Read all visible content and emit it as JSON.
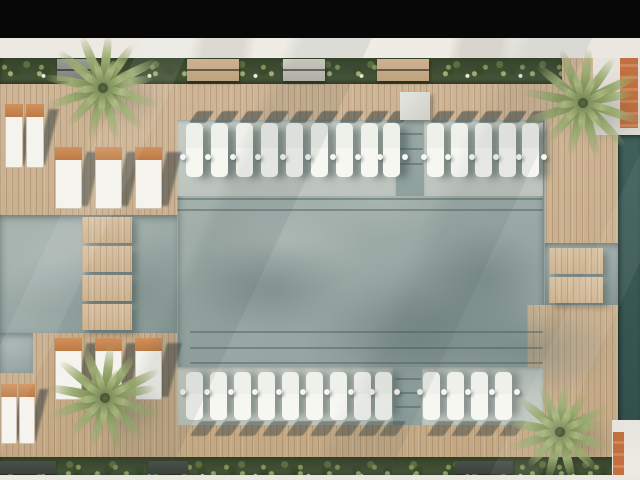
{
  "scene": {
    "type": "architectural-render-top-view",
    "subject": "Resort swimming pool seen from directly above: timber deck frame, two rows of white in-pool sun loungers with round side tables, timber stepping walkways crossing the water, cushioned lounge chairs on the deck, four palm trees, planting strips along the top and bottom edges, and a dark reflecting channel on the right.",
    "colors": {
      "letterbox": "#070707",
      "marble_walkway": "#ebe8e2",
      "wood_light": "#d8c2a4",
      "wood_mid": "#c7ad8c",
      "water_light": "#bcc4be",
      "water_mid": "#9fafab",
      "water_deep": "#839794",
      "channel_teal": "#3c5a56",
      "shelf_gray": "#c5cbc4",
      "lounger_white": "#f3f3ee",
      "chair_wood": "#c98a54",
      "shadow_tone": "#31424a",
      "green_dark": "#34422a",
      "palm_olive": "#8ba06b"
    },
    "lounger_rows": [
      {
        "id": "top",
        "y": 123,
        "w": 17,
        "h": 54,
        "table_y": 154,
        "shadow": "deck-above",
        "groups": [
          [
            186,
            211,
            236,
            261,
            286,
            311,
            336,
            361,
            383
          ],
          [
            427,
            451,
            475,
            499,
            522
          ]
        ]
      },
      {
        "id": "bottom",
        "y": 372,
        "w": 17,
        "h": 48,
        "table_y": 389,
        "shadow": "deck-below",
        "groups": [
          [
            186,
            210,
            234,
            258,
            282,
            306,
            330,
            354,
            375
          ],
          [
            423,
            447,
            471,
            495
          ]
        ]
      }
    ],
    "walkways": [
      {
        "id": "left",
        "x": 82,
        "w": 50,
        "seg_h": 26,
        "ys": [
          217,
          246,
          275,
          304
        ]
      },
      {
        "id": "right",
        "x": 549,
        "w": 54,
        "seg_h": 26,
        "ys": [
          248,
          277
        ]
      }
    ],
    "chair_groups": [
      {
        "id": "top-left-pair",
        "y": 104,
        "w": 18,
        "h": 64,
        "xs": [
          5,
          26
        ]
      },
      {
        "id": "top-row",
        "y": 147,
        "w": 27,
        "h": 62,
        "xs": [
          55,
          95,
          135
        ]
      },
      {
        "id": "bottom-row",
        "y": 338,
        "w": 27,
        "h": 62,
        "xs": [
          55,
          95,
          135
        ]
      },
      {
        "id": "bottom-left-pair",
        "y": 384,
        "w": 16,
        "h": 60,
        "xs": [
          1,
          19
        ]
      }
    ],
    "palms": [
      {
        "cx": 103,
        "cy": 88,
        "r": 62
      },
      {
        "cx": 583,
        "cy": 103,
        "r": 64
      },
      {
        "cx": 105,
        "cy": 398,
        "r": 62
      },
      {
        "cx": 560,
        "cy": 432,
        "r": 56
      }
    ],
    "planter_benches": [
      {
        "x": 57,
        "w": 34,
        "tone": "gray"
      },
      {
        "x": 187,
        "w": 52,
        "tone": "wood"
      },
      {
        "x": 283,
        "w": 42,
        "tone": "light"
      },
      {
        "x": 377,
        "w": 52,
        "tone": "wood"
      }
    ],
    "planter_boxes_bottom": [
      {
        "x": 0,
        "w": 56
      },
      {
        "x": 148,
        "w": 40
      },
      {
        "x": 455,
        "w": 58
      }
    ],
    "steps": [
      {
        "x": 177,
        "w": 366,
        "ys": [
          198,
          209
        ]
      },
      {
        "x": 190,
        "w": 353,
        "ys": [
          331,
          347,
          362
        ]
      },
      {
        "x": 397,
        "w": 26,
        "ys": [
          133,
          148,
          163
        ]
      },
      {
        "x": 395,
        "w": 26,
        "ys": [
          378,
          392,
          406
        ]
      }
    ],
    "shadow_blobs": [
      {
        "x": 185,
        "y": 240,
        "w": 170,
        "h": 95,
        "o": 0.45
      },
      {
        "x": 300,
        "y": 285,
        "w": 230,
        "h": 110,
        "o": 0.4
      },
      {
        "x": 420,
        "y": 225,
        "w": 130,
        "h": 105,
        "o": 0.5
      },
      {
        "x": 455,
        "y": 300,
        "w": 160,
        "h": 100,
        "o": 0.45
      },
      {
        "x": 186,
        "y": 128,
        "w": 90,
        "h": 60,
        "o": 0.3
      }
    ]
  }
}
